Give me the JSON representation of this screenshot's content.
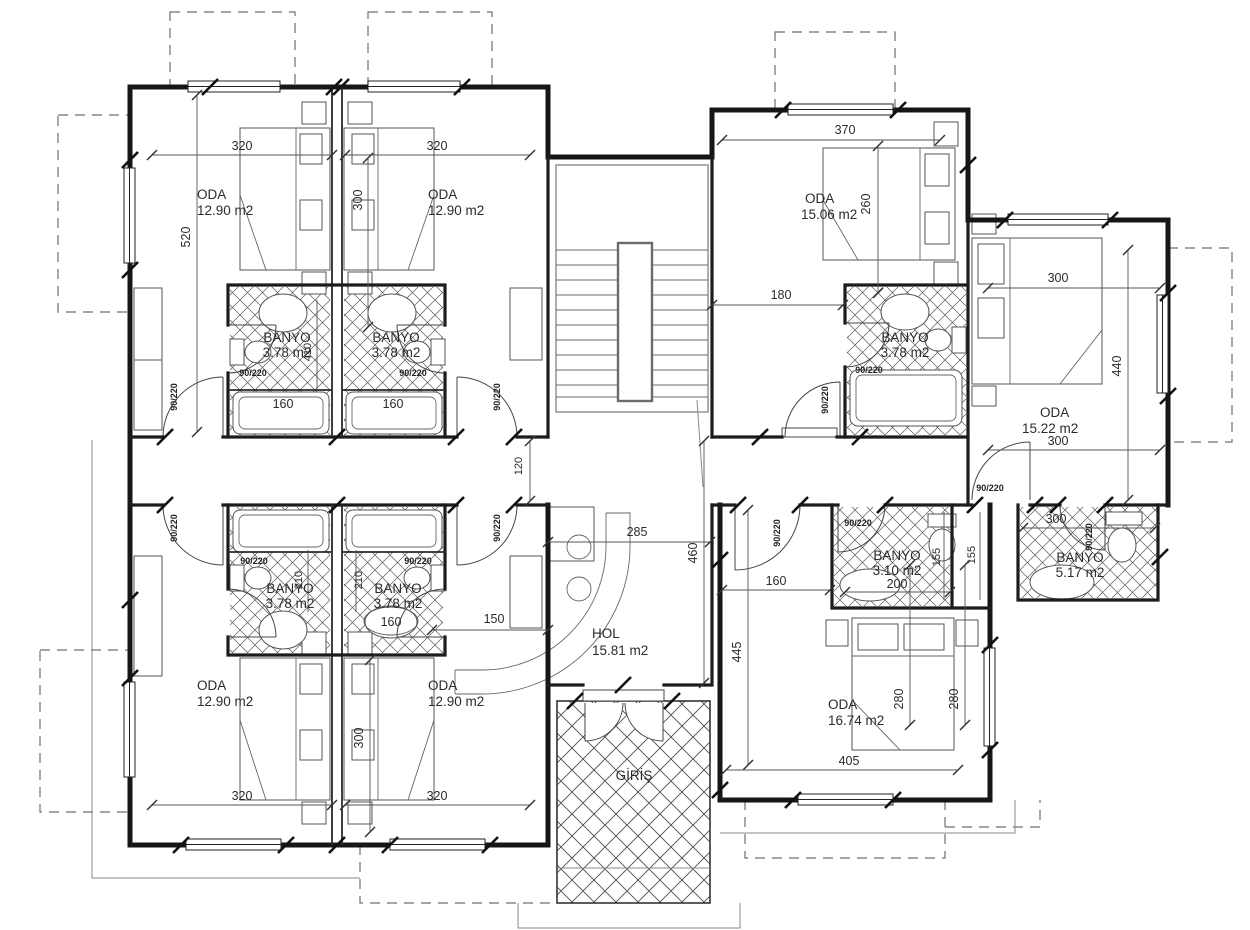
{
  "drawing": {
    "door_label": "90/220",
    "rooms": {
      "oda_tl_left": {
        "name": "ODA",
        "area": "12.90 m2"
      },
      "oda_tl_right": {
        "name": "ODA",
        "area": "12.90 m2"
      },
      "banyo_tl_left": {
        "name": "BANYO",
        "area": "3.78 m2"
      },
      "banyo_tl_right": {
        "name": "BANYO",
        "area": "3.78 m2"
      },
      "oda_tr": {
        "name": "ODA",
        "area": "15.06 m2"
      },
      "banyo_tr": {
        "name": "BANYO",
        "area": "3.78 m2"
      },
      "oda_right": {
        "name": "ODA",
        "area": "15.22 m2"
      },
      "hol": {
        "name": "HOL",
        "area": "15.81 m2"
      },
      "giris": {
        "name": "GİRİŞ"
      },
      "banyo_bl_left": {
        "name": "BANYO",
        "area": "3.78 m2"
      },
      "banyo_bl_right": {
        "name": "BANYO",
        "area": "3.78 m2"
      },
      "oda_bl_left": {
        "name": "ODA",
        "area": "12.90 m2"
      },
      "oda_bl_right": {
        "name": "ODA",
        "area": "12.90 m2"
      },
      "banyo_br_small": {
        "name": "BANYO",
        "area": "3.10 m2"
      },
      "banyo_br_large": {
        "name": "BANYO",
        "area": "5.17 m2"
      },
      "oda_br": {
        "name": "ODA",
        "area": "16.74 m2"
      }
    },
    "dims": {
      "tl_left_width": "320",
      "tl_right_width": "320",
      "tl_right_depth": "300",
      "tl_left_depth": "520",
      "tl_banyo_depth": "410",
      "tl_tub_left": "160",
      "tl_tub_right": "160",
      "corridor": "120",
      "bl_banyo_left": "210",
      "bl_banyo_right": "210",
      "bl_tub": "160",
      "hall_150": "150",
      "bl_left_width": "320",
      "bl_right_width": "320",
      "bl_right_depth": "300",
      "hol_width": "285",
      "hol_depth": "460",
      "tr_width": "370",
      "tr_depth": "260",
      "tr_hall": "180",
      "r_width_top": "300",
      "r_depth": "440",
      "r_width_bottom": "300",
      "br_hall": "160",
      "br_depth": "445",
      "br_banyo_small": "200",
      "br_shaft_a": "155",
      "br_shaft_b": "155",
      "br_banyo_large": "300",
      "br_bed_a": "280",
      "br_bed_b": "280",
      "br_width": "405"
    }
  }
}
